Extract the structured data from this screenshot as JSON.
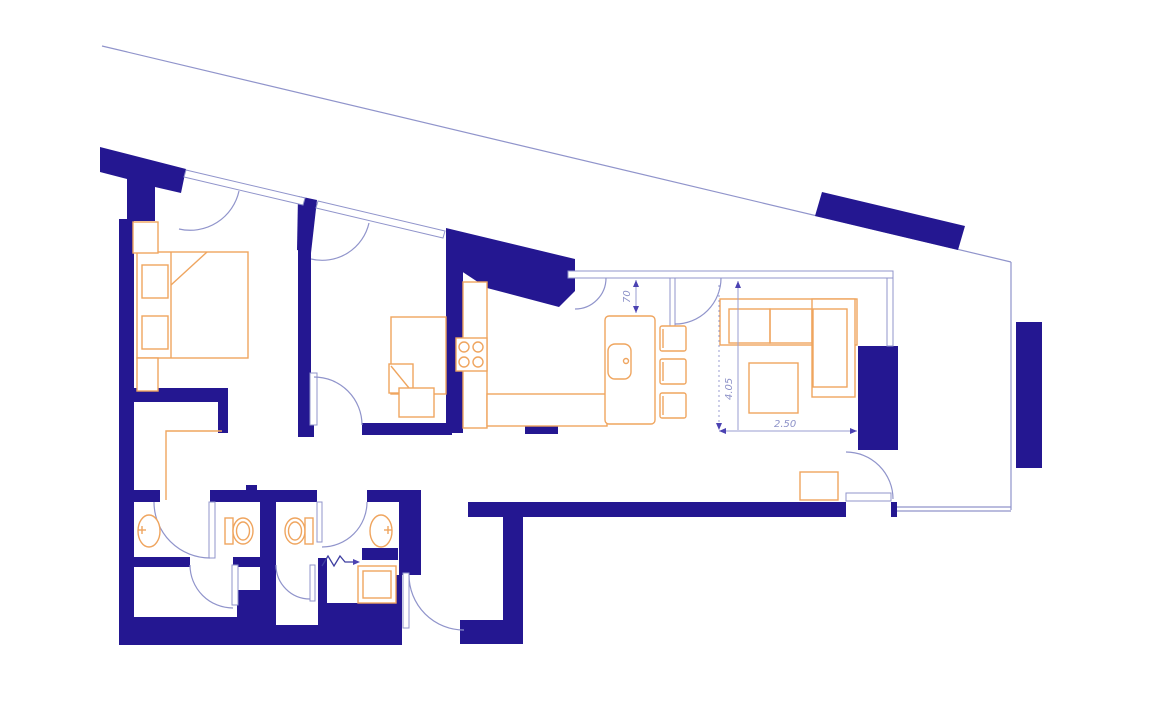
{
  "plan": {
    "type": "apartment-floor-plan",
    "dimensions": {
      "kitchen_clearance": "70",
      "living_depth": "4.05",
      "living_width": "2.50"
    },
    "colors": {
      "background": "#ffffff",
      "wall": "#241791",
      "thin_line": "#9094cb",
      "furniture": "#efa55f",
      "dimension_line": "#9a9ed2",
      "dimension_text": "#8d92c8",
      "arrow": "#4b42b2",
      "symbol": "#3d3da0"
    },
    "elements": {
      "rooms": [
        "bedroom-1",
        "bedroom-2",
        "kitchen-dining",
        "living-room",
        "hallway",
        "entry-vestibule",
        "bathroom-left",
        "bathroom-right",
        "shower-room",
        "terrace"
      ],
      "furniture": [
        "double-bed",
        "nightstand",
        "dresser",
        "hall-wardrobe",
        "desk-bed",
        "chair",
        "stool",
        "kitchen-counter",
        "stove",
        "kitchen-island",
        "island-sink",
        "bar-stools",
        "sofa",
        "chaise",
        "coffee-table",
        "sideboard"
      ],
      "fixtures": [
        "washbasin-left",
        "toilet-left",
        "toilet-right",
        "washbasin-right",
        "shower-tray",
        "radiator-symbol"
      ],
      "openings": [
        "window-swings",
        "door-swings",
        "entrance-door",
        "terrace-door"
      ]
    }
  }
}
